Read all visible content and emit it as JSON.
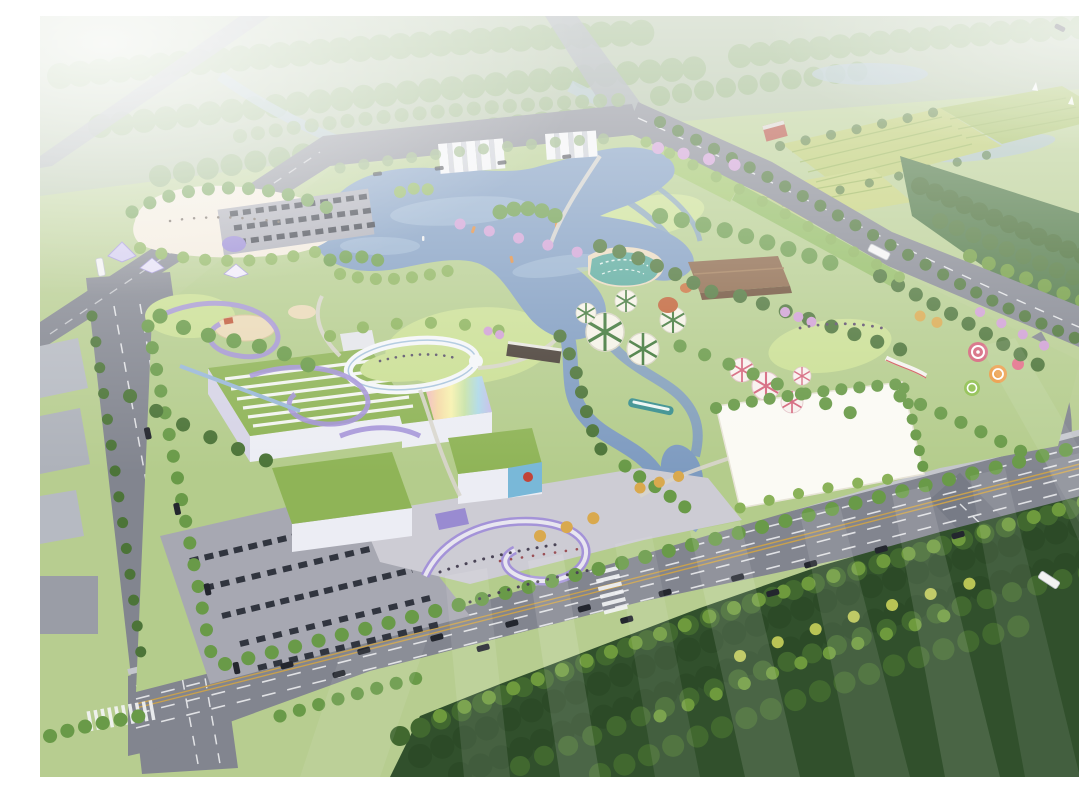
{
  "scene": {
    "type": "photorealistic-aerial-rendering",
    "subject": "lakeside-theme-park-masterplan-birdseye",
    "text_content": "none",
    "width": 1079,
    "height": 761,
    "features": [
      "hazy-forest-horizon",
      "highway-interchange",
      "farmland-plots",
      "farmhouse-red-roof",
      "central-lake-with-boats",
      "white-sand-beach-plaza",
      "playground-purple-paths",
      "purple-event-tents",
      "circular-canopy-walkway",
      "green-roof-exhibition-buildings",
      "rainbow-roof-building",
      "billboard-mural-building",
      "visitor-entrance-plaza",
      "surface-parking-lot",
      "leaf-pattern-canopies",
      "timber-pavilion",
      "wave-pool",
      "candy-theme-playground",
      "white-event-lawn",
      "wetland-streams",
      "wooden-bridge",
      "sightseeing-boat",
      "city-boulevard-with-traffic",
      "dense-south-forest",
      "glass-reflection-streak-overlay",
      "top-haze"
    ]
  },
  "palette": {
    "ground": "#b7cd90",
    "park_lawn": "#b4cc8c",
    "lawn_bright": "#cadf93",
    "greenway": "#9fc468",
    "lake": "#7e9bc0",
    "lake_light": "#a9c2da",
    "water_far": "#a7bdcb",
    "stream": "#7fa3c0",
    "road": "#82858f",
    "road_far": "#9aa0a8",
    "lane": "#f2f3f5",
    "center_line": "#c9a14d",
    "sidewalk": "#c4c6cc",
    "tree": "#699a48",
    "tree_dark": "#4c7438",
    "tree_light": "#8ab259",
    "tree_far": "#8fae78",
    "forest_base": "#31502c",
    "forest_dark": "#2c4a27",
    "forest_mid": "#41682f",
    "forest_light": "#6e9a3d",
    "forest_accent": "#b9c455",
    "autumn": "#d9a94e",
    "blossom": "#cf9fd4",
    "beach": "#f2e9da",
    "plaza_white": "#fbfaf4",
    "plaza_gray": "#cdccd4",
    "parking": "#a7a8b2",
    "warehouse": "#b6bac2",
    "building_wall": "#ecedf4",
    "building_side": "#c9c6dd",
    "roof_green": "#8fb457",
    "roof_stripe": "#f2f4f0",
    "mural_blue": "#79b8d8",
    "mural_red": "#c24438",
    "pavilion": "#8a6547",
    "pavilion_dark": "#6b4c34",
    "canopy_white": "#f5f2e6",
    "canopy_rib": "#3e7637",
    "umbrella_pink": "#d4637a",
    "pool_teal": "#57a89b",
    "path_purple": "#a493d8",
    "tent_purple": "#8f7fd0",
    "sand": "#ead9b6",
    "car": "#23262e",
    "bus": "#f2f2f2",
    "boat": "#e08a3c",
    "dock_boat": "#3a8f8f",
    "farm_a": "#b9c96a",
    "farm_b": "#a2bd5e",
    "farm_row": "#8fae4d",
    "house_roof": "#b24a3a",
    "rainbow": [
      "#f2b8c8",
      "#f5d9a8",
      "#f7f2b0",
      "#c8e3a8",
      "#aed9e8",
      "#c8bce8"
    ],
    "ghost": "#ffffff"
  }
}
